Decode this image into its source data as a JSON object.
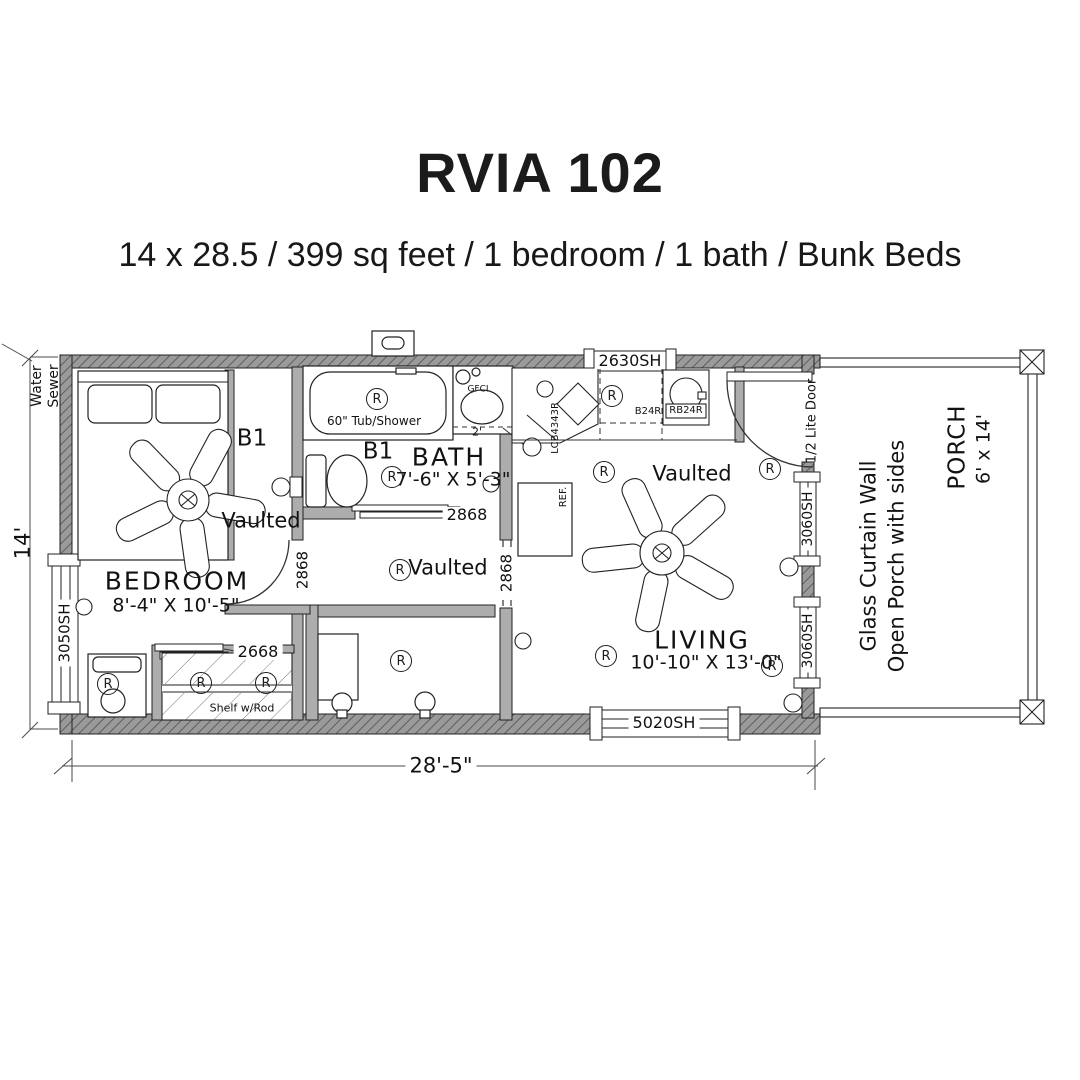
{
  "title": "RVIA 102",
  "subtitle": "14 x 28.5 / 399 sq feet / 1 bedroom / 1 bath / Bunk Beds",
  "plan": {
    "dims": {
      "width": "28'-5\"",
      "height": "14'"
    },
    "utilities": {
      "water": "Water",
      "sewer": "Sewer"
    },
    "symbols": {
      "receptacle": "R",
      "gfci": "GFCI"
    },
    "notes": {
      "vaulted": "Vaulted",
      "b1": "B1"
    },
    "rooms": {
      "bedroom": {
        "name": "BEDROOM",
        "size": "8'-4\" X 10'-5\""
      },
      "bath": {
        "name": "BATH",
        "size": "7'-6\" X 5'-3\"",
        "tub": "60\" Tub/Shower",
        "vanity_depth": "2'"
      },
      "living": {
        "name": "LIVING",
        "size": "10'-10\" X 13'-0\""
      },
      "closet": {
        "shelf": "Shelf w/Rod"
      },
      "porch": {
        "name": "PORCH",
        "size": "6' x 14'",
        "note1": "Glass Curtain Wall",
        "note2": "Open Porch with sides"
      }
    },
    "windows": {
      "left": "3050SH",
      "kitchen": "2630SH",
      "living_bottom": "5020SH",
      "living_right": "3060SH"
    },
    "doors": {
      "bedroom": "2868",
      "bath": "2868",
      "living_opening": "2868",
      "closet": "2668",
      "entry": "1/2 Lite Door"
    },
    "kitchen": {
      "base_cab": "B24R",
      "range": "RB24R",
      "corner_cab": "LCB4343R",
      "fridge": "REF."
    }
  }
}
